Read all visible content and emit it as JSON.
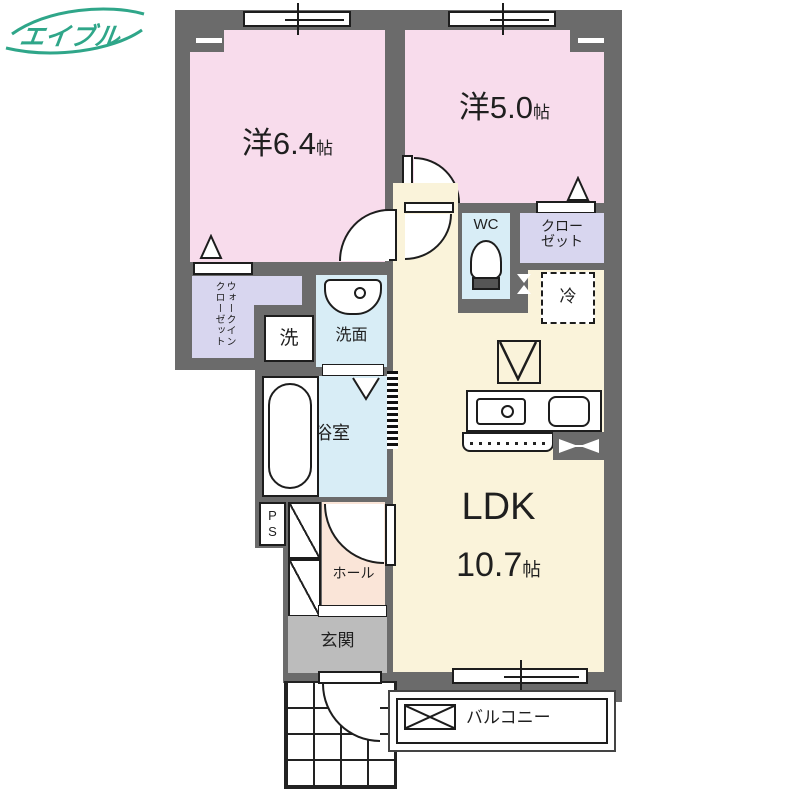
{
  "colors": {
    "wall": "#6b6b6b",
    "bedroom": "#f8dcec",
    "ldk": "#faf3da",
    "wet": "#d8edf6",
    "closet": "#d8d6ef",
    "hall": "#fae5d8",
    "genkan": "#bcbcbc",
    "logo": "#2fa689"
  },
  "logo": {
    "text": "エイブル"
  },
  "rooms": {
    "bedroom1": {
      "name": "洋6.4",
      "unit": "帖"
    },
    "bedroom2": {
      "name": "洋5.0",
      "unit": "帖"
    },
    "ldk": {
      "name": "LDK",
      "size": "10.7",
      "unit": "帖"
    },
    "wc": {
      "label": "WC"
    },
    "closet": {
      "label": "クローゼット",
      "line1": "クロー",
      "line2": "ゼット"
    },
    "walk_in_closet": {
      "label": "ウォークインクローゼット",
      "column_right": "ウォークイン",
      "column_left": "クローゼット"
    },
    "washer": {
      "label": "洗"
    },
    "washroom": {
      "label": "洗面"
    },
    "bathroom": {
      "label": "浴室"
    },
    "pipe_space": {
      "label": "PS"
    },
    "hall": {
      "label": "ホール"
    },
    "entrance": {
      "label": "玄関"
    },
    "balcony": {
      "label": "バルコニー"
    },
    "refrigerator": {
      "label": "冷"
    }
  }
}
